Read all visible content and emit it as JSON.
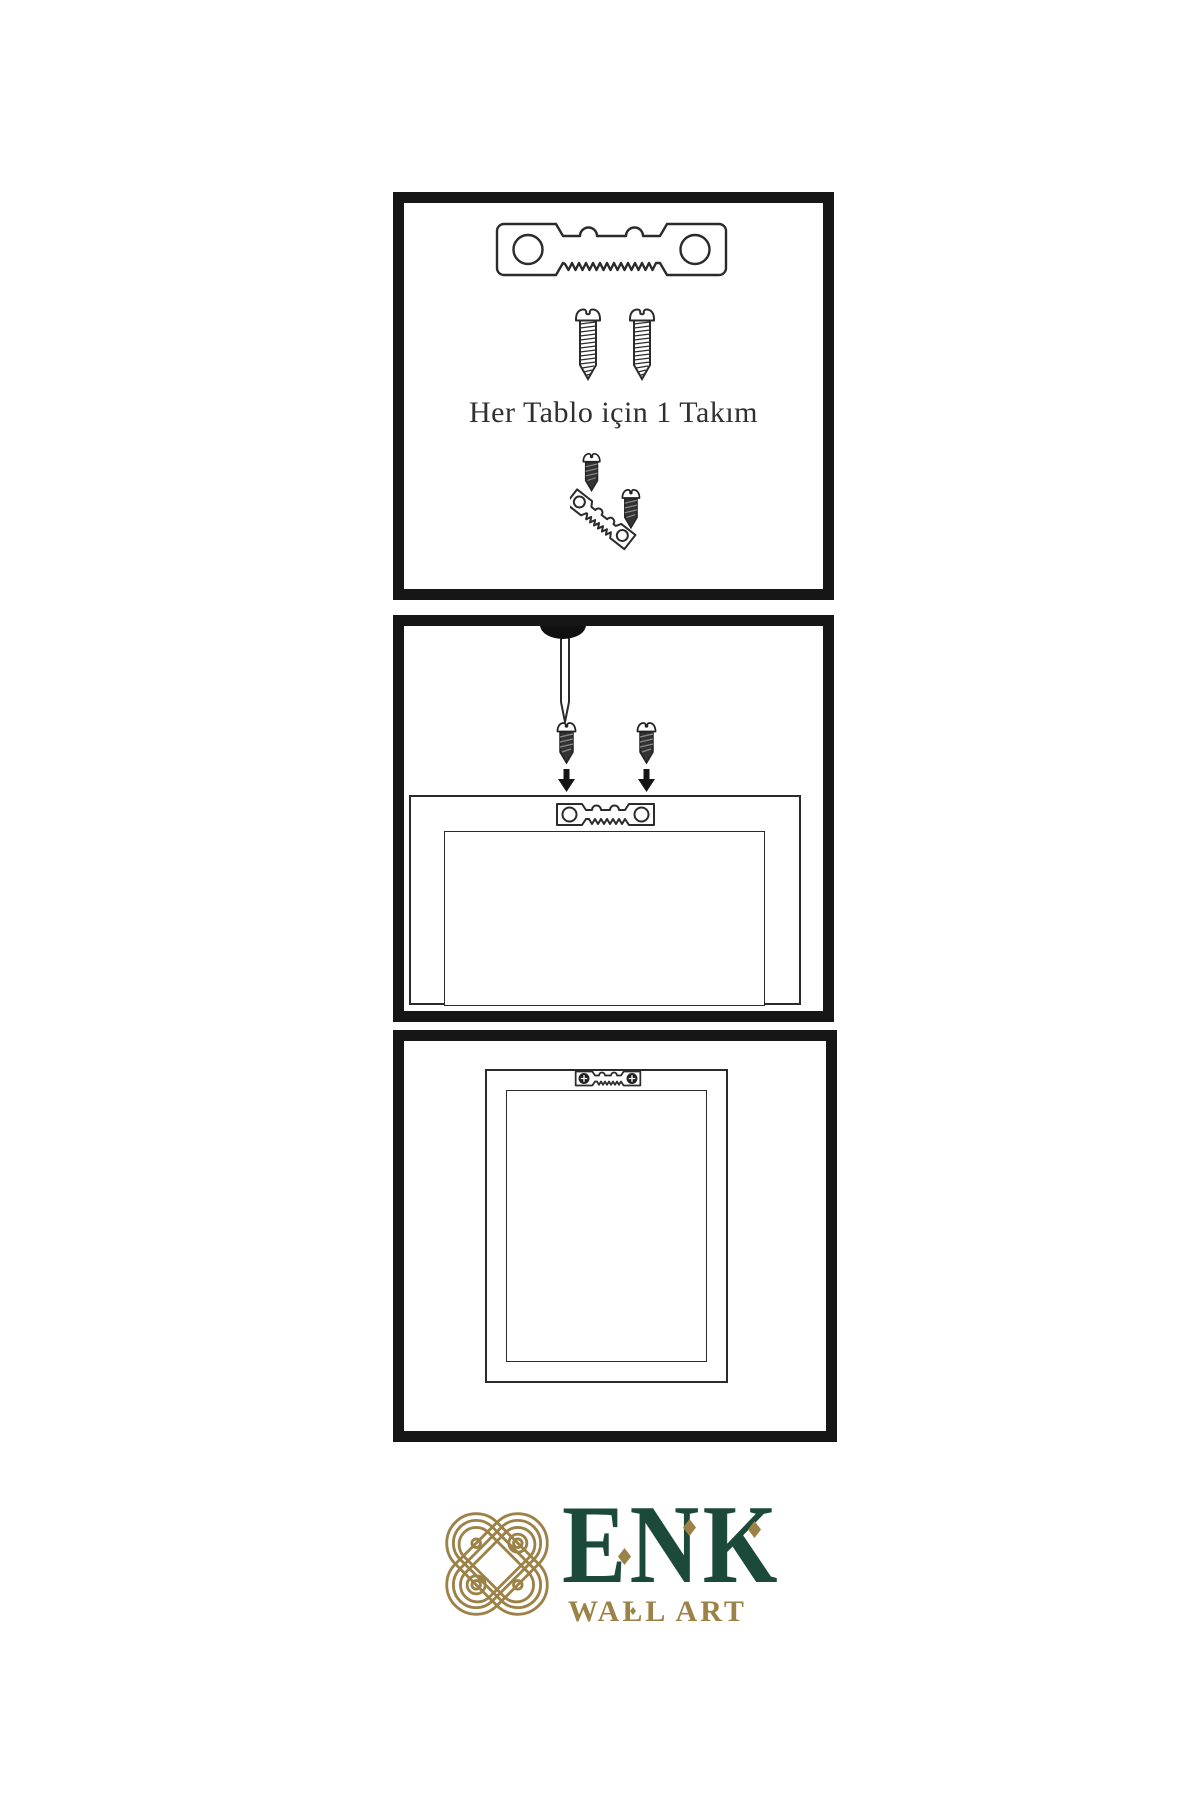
{
  "page": {
    "title": "Wall art hanging instruction sheet"
  },
  "colors": {
    "background": "#ffffff",
    "panel_border": "#161616",
    "line": "#2b2b2b",
    "brand_green": "#1c4a3a",
    "brand_gold": "#9c8247"
  },
  "instructions": {
    "set_caption": "Her Tablo için 1 Takım"
  },
  "icons": [
    "sawtooth-hanger-icon",
    "screw-icon",
    "dark-screw-icon",
    "nail-icon",
    "arrow-down-icon",
    "frame-icon",
    "knot-logo-icon"
  ],
  "brand": {
    "name": "ENK",
    "tagline": "WALL ART"
  }
}
